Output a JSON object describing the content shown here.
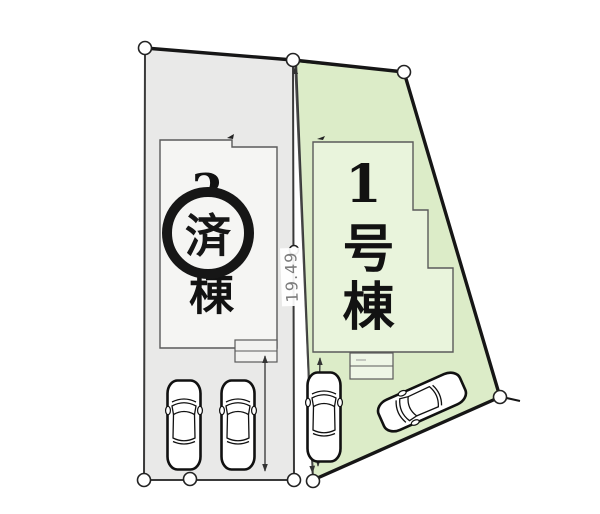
{
  "plan": {
    "dimension": {
      "label": "19.49",
      "color": "#7c7c7c"
    },
    "lots": {
      "lot1": {
        "label": "1号棟",
        "fill": "#dcecc8",
        "building_fill": "#e9f4dc"
      },
      "lot2": {
        "label": "2号棟",
        "stamp": "済",
        "fill": "#e9e9e8",
        "building_fill": "#f5f5f3"
      }
    },
    "icons": {
      "car": "car-top-view",
      "survey_marker": "white-circle-point"
    }
  }
}
